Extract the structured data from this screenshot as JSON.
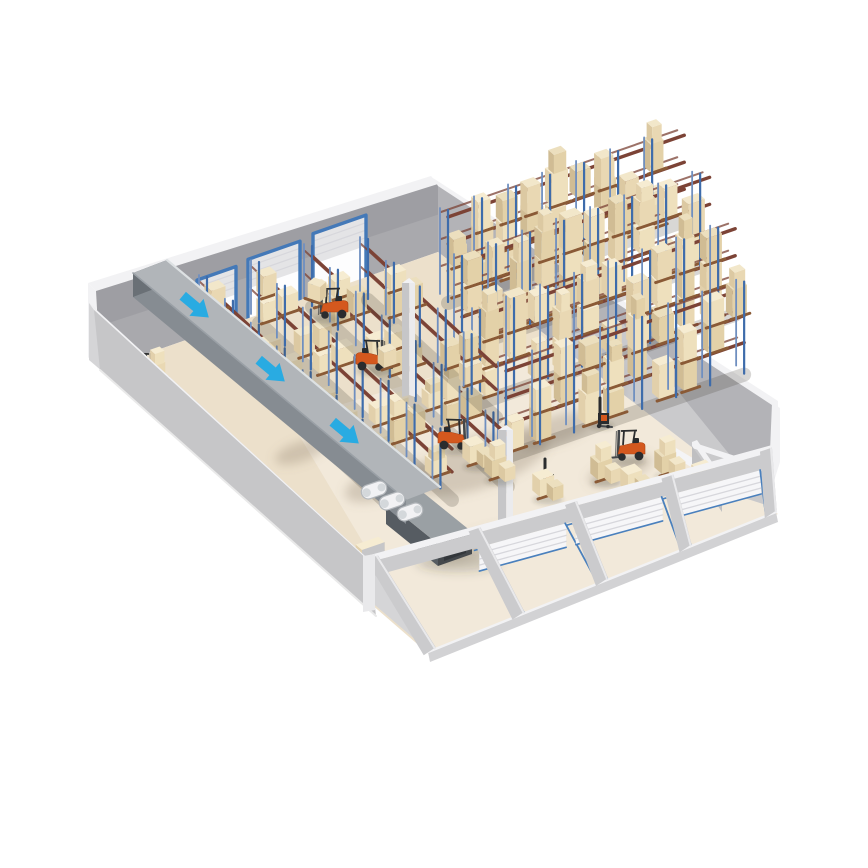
{
  "page": {
    "width": 868,
    "height": 868,
    "background": "#ffffff",
    "subject": "isometric-cutaway-warehouse-illustration"
  },
  "palette": {
    "wall_back_face": "#a9a9ad",
    "wall_back_shade": "rgba(70,70,78,0.10)",
    "wall_right_face": "#b3b3b7",
    "wall_stain": "rgba(122,122,130,0.35)",
    "wall_edge_white": "#f2f2f4",
    "wall_outer_left": "#d5d5d7",
    "wall_inner_left": "#c6c6c8",
    "wall_skirt": "#e9e9e9",
    "floor": "#ece0cb",
    "floor_front_light": "rgba(255,255,255,0.30)",
    "floor_patch": "rgba(130,115,92,0.28)",
    "front_frame": "#cbcbcd",
    "front_frame_light": "#e9e9eb",
    "sill": "#d2d2d4",
    "conveyor_top": "#b1b5b9",
    "conveyor_side": "#868c92",
    "conveyor_end": "#6a7076",
    "conveyor_highlight": "#dde1e3",
    "chute_top": "#9aa0a4",
    "chute_side": "#565c62",
    "chute_end": "#44484c",
    "chute_inner": "#33373b",
    "motor_body": "#f2f2f4",
    "motor_edge": "#b4b8bc",
    "motor_cap": "#d4d8db",
    "arrow": "#29abe2",
    "door_frame_blue": "#4479b8",
    "door_leaf": "#e4e4e6",
    "door_open_light": "#fdfdfe",
    "shutter": "#f6f6f8",
    "shutter_line": "#d7d7dc",
    "rail_blue": "#4a80bd",
    "rack_post": "#3e6cab",
    "rack_post_back": "#6f8fc0",
    "rack_beam": "#7c4336",
    "pallet": "#8a5a36",
    "box_a_top": "#f2e7ca",
    "box_a_left": "#dcc9a2",
    "box_a_right": "#e9d8b3",
    "box_b_top": "#f6ecd2",
    "box_b_left": "#e2d0ab",
    "box_b_right": "#eee0bd",
    "box_c_top": "#ecdfbe",
    "box_c_left": "#d0bc94",
    "box_c_right": "#e3d1a8",
    "forklift_orange": "#d4581e",
    "forklift_orange_dark": "#a84416",
    "machine_dark": "#2a2c2e",
    "mast_gray": "#44474a",
    "shadow": "rgba(60,55,45,0.20)",
    "column_light": "#ebebed",
    "column_shade": "#c6c6c8",
    "room_wall": "#c9c9cb",
    "room_wall_dark": "#bfbfc1",
    "niche_white": "#f4f4f6"
  },
  "scene": {
    "walls": {
      "back": {
        "top": [
          [
            96,
            291
          ],
          [
            438,
            184
          ]
        ],
        "base": [
          [
            100,
            370
          ],
          [
            438,
            252
          ]
        ]
      },
      "right": {
        "face": [
          [
            438,
            184
          ],
          [
            772,
            403
          ],
          [
            776,
            452
          ],
          [
            756,
            500
          ],
          [
            438,
            252
          ]
        ],
        "top_strip": [
          [
            433,
            178
          ],
          [
            778,
            401
          ],
          [
            778,
            409
          ],
          [
            438,
            186
          ]
        ],
        "outer_sliver": [
          [
            772,
            403
          ],
          [
            780,
            408
          ],
          [
            780,
            462
          ],
          [
            768,
            500
          ]
        ]
      },
      "left": {
        "inner_top": [
          [
            94,
            310
          ],
          [
            370,
            562
          ]
        ],
        "inner_base": [
          [
            100,
            370
          ],
          [
            376,
            616
          ]
        ],
        "band": [
          [
            89,
            303
          ],
          [
            365,
            556
          ],
          [
            370,
            562
          ],
          [
            94,
            310
          ]
        ],
        "outer": [
          [
            89,
            303
          ],
          [
            365,
            556
          ],
          [
            432,
            654
          ],
          [
            89,
            360
          ]
        ]
      },
      "front": {
        "top": [
          [
            370,
            562
          ],
          [
            772,
            452
          ]
        ],
        "beam_h": 15,
        "sill": [
          [
            428,
            652
          ],
          [
            776,
            512
          ]
        ],
        "sill_h": 10,
        "posts_t": [
          0.005,
          0.26,
          0.5,
          0.74,
          0.985
        ],
        "shutter_bays": [
          [
            0.26,
            0.5
          ],
          [
            0.5,
            0.74
          ],
          [
            0.74,
            0.985
          ]
        ]
      }
    },
    "floor": {
      "outline": [
        [
          100,
          370
        ],
        [
          438,
          252
        ],
        [
          758,
          498
        ],
        [
          778,
          514
        ],
        [
          430,
          655
        ]
      ]
    },
    "floor_patches": [
      {
        "cx": 480,
        "cy": 462,
        "rx": 72,
        "ry": 26
      },
      {
        "cx": 385,
        "cy": 482,
        "rx": 42,
        "ry": 16
      },
      {
        "cx": 556,
        "cy": 430,
        "rx": 40,
        "ry": 14
      },
      {
        "cx": 300,
        "cy": 452,
        "rx": 26,
        "ry": 10
      },
      {
        "cx": 476,
        "cy": 545,
        "rx": 46,
        "ry": 12
      },
      {
        "cx": 620,
        "cy": 470,
        "rx": 34,
        "ry": 11
      }
    ],
    "wall_stains": [
      {
        "cx": 462,
        "cy": 300,
        "rx": 22,
        "ry": 48
      },
      {
        "cx": 600,
        "cy": 380,
        "rx": 26,
        "ry": 40
      },
      {
        "cx": 520,
        "cy": 330,
        "rx": 14,
        "ry": 30
      }
    ],
    "dock_doors_back": [
      {
        "x1": 197,
        "x2": 236
      },
      {
        "x1": 248,
        "x2": 300
      },
      {
        "x1": 313,
        "x2": 366
      }
    ],
    "conveyor": {
      "edge_near": [
        [
          133,
          273
        ],
        [
          406,
          500
        ]
      ],
      "edge_far": [
        [
          167,
          260
        ],
        [
          440,
          487
        ]
      ],
      "depth": 24,
      "motors": [
        [
          374,
          490
        ],
        [
          392,
          501
        ],
        [
          410,
          512
        ]
      ],
      "chute": {
        "top": [
          [
            386,
            502
          ],
          [
            420,
            490
          ],
          [
            472,
            532
          ],
          [
            438,
            544
          ]
        ],
        "side": [
          [
            386,
            502
          ],
          [
            438,
            544
          ],
          [
            438,
            566
          ],
          [
            386,
            524
          ]
        ],
        "end": [
          [
            438,
            544
          ],
          [
            472,
            532
          ],
          [
            472,
            554
          ],
          [
            438,
            566
          ]
        ],
        "inner": [
          [
            444,
            548
          ],
          [
            466,
            540
          ],
          [
            466,
            553
          ],
          [
            444,
            561
          ]
        ]
      }
    },
    "flow_arrows": {
      "direction": "down-right",
      "positions": [
        [
          195,
          306
        ],
        [
          271,
          370
        ],
        [
          345,
          432
        ]
      ]
    },
    "columns": [
      {
        "x": 402,
        "base": 397,
        "w": 13,
        "h": 114
      },
      {
        "x": 498,
        "base": 552,
        "w": 15,
        "h": 122
      }
    ],
    "rack_rows_left": [
      {
        "x": 207,
        "y": 333,
        "len": 262,
        "dir": "v",
        "seed": 1,
        "fill": 6
      },
      {
        "x": 259,
        "y": 318,
        "len": 268,
        "dir": "v",
        "seed": 2,
        "fill": 6
      },
      {
        "x": 312,
        "y": 302,
        "len": 272,
        "dir": "v",
        "seed": 3,
        "fill": 6
      },
      {
        "x": 368,
        "y": 295,
        "len": 178,
        "dir": "v",
        "seed": 4,
        "fill": 5
      }
    ],
    "rack_rows_right": [
      {
        "x": 448,
        "y": 298,
        "len": 250,
        "dir": "u",
        "seed": 5,
        "fill": 8
      },
      {
        "x": 462,
        "y": 344,
        "len": 262,
        "dir": "u",
        "seed": 6,
        "fill": 8
      },
      {
        "x": 480,
        "y": 398,
        "len": 270,
        "dir": "u",
        "seed": 7,
        "fill": 8
      },
      {
        "x": 506,
        "y": 452,
        "len": 252,
        "dir": "u",
        "seed": 8,
        "fill": 6
      }
    ],
    "forklifts": [
      {
        "x": 140,
        "y": 381,
        "flip": false,
        "load": 2,
        "lift": 0
      },
      {
        "x": 333,
        "y": 316,
        "flip": true,
        "load": 1,
        "lift": 14
      },
      {
        "x": 371,
        "y": 368,
        "flip": false,
        "load": 1,
        "lift": 0
      },
      {
        "x": 453,
        "y": 447,
        "flip": false,
        "load": 0,
        "lift": 0
      },
      {
        "x": 630,
        "y": 458,
        "flip": true,
        "load": 0,
        "lift": 0
      }
    ],
    "stackers": [
      {
        "x": 545,
        "y": 485
      },
      {
        "x": 600,
        "y": 424
      }
    ],
    "floor_stacks": [
      {
        "x": 470,
        "y": 464,
        "t": 1
      },
      {
        "x": 492,
        "y": 478,
        "t": 2
      },
      {
        "x": 598,
        "y": 480,
        "t": 2
      },
      {
        "x": 628,
        "y": 492,
        "t": 1
      },
      {
        "x": 662,
        "y": 474,
        "t": 2
      },
      {
        "x": 699,
        "y": 488,
        "t": 1
      },
      {
        "x": 540,
        "y": 497,
        "t": 1
      }
    ],
    "corner_room": {
      "wall_u_band": [
        [
          692,
          442
        ],
        [
          766,
          466
        ],
        [
          766,
          472
        ],
        [
          692,
          448
        ]
      ],
      "wall_u_face": [
        [
          692,
          448
        ],
        [
          766,
          472
        ],
        [
          766,
          505
        ],
        [
          692,
          481
        ]
      ],
      "wall_v_band": [
        [
          692,
          442
        ],
        [
          722,
          486
        ],
        [
          727,
          484
        ],
        [
          697,
          440
        ]
      ],
      "wall_v_face": [
        [
          692,
          446
        ],
        [
          722,
          490
        ],
        [
          722,
          512
        ],
        [
          692,
          468
        ]
      ],
      "niche": [
        [
          676,
          448
        ],
        [
          706,
          466
        ],
        [
          706,
          476
        ],
        [
          676,
          458
        ]
      ]
    },
    "slab": {
      "x": 362,
      "y": 598,
      "w": 24,
      "d": 9,
      "h": 48
    }
  }
}
